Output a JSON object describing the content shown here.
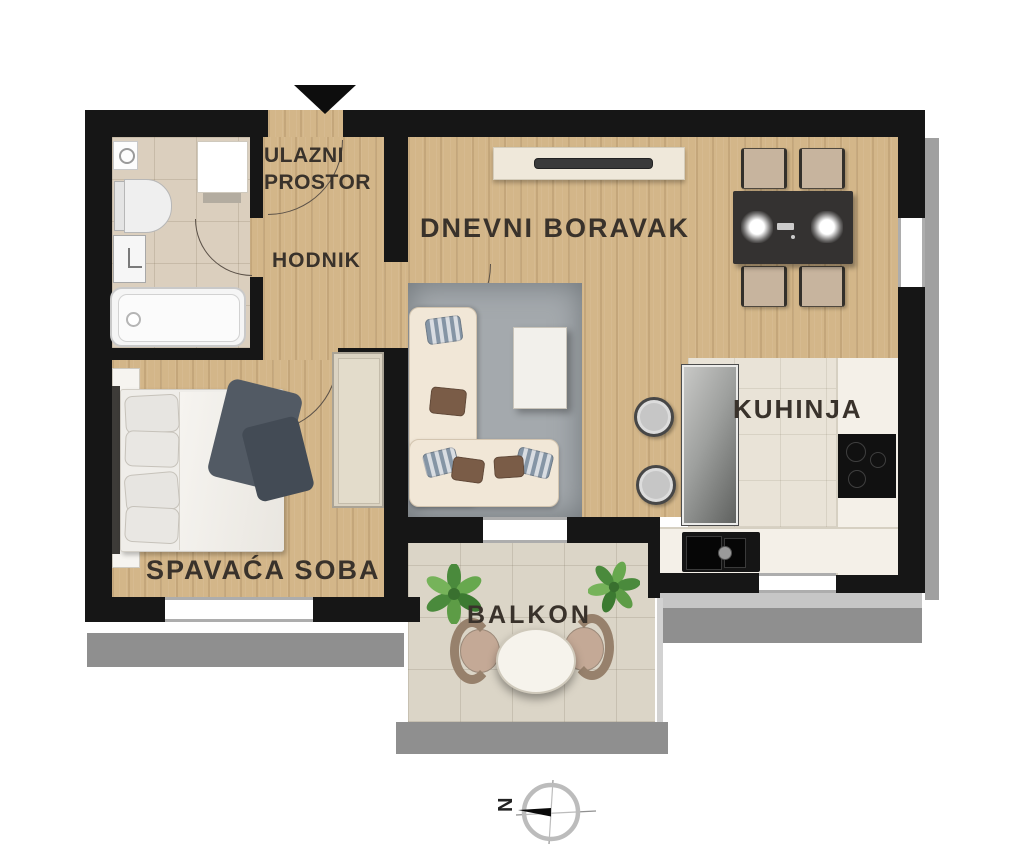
{
  "rooms": {
    "entry": {
      "line1": "ULAZNI",
      "line2": "PROSTOR"
    },
    "hallway": {
      "label": "HODNIK"
    },
    "living_room": {
      "label": "DNEVNI BORAVAK"
    },
    "kitchen": {
      "label": "KUHINJA"
    },
    "bedroom": {
      "label": "SPAVAĆA SOBA"
    },
    "balcony": {
      "label": "BALKON"
    }
  },
  "compass": {
    "north_label": "N",
    "needle_points": "left"
  },
  "entry_marker": {
    "type": "entrance-arrow",
    "points": "down"
  },
  "colors": {
    "wall": "#161616",
    "wood_floor": "#d3b689",
    "bathroom_tile": "#dbcfbe",
    "kitchen_tile": "#e9e3d7",
    "balcony_tile": "#dbd5c7",
    "building_shadow": "#8f8f8f",
    "rug": "#a4a9ad",
    "sofa": "#f1e7d7",
    "dining_table": "#343231",
    "plant_green": "#4a8a3c",
    "label_text": "#39322b"
  },
  "furniture": {
    "bathroom": [
      "toilet",
      "washing-machine",
      "bathtub",
      "washbasin",
      "floor-drain"
    ],
    "living_room": [
      "tv-cabinet",
      "dining-table",
      "dining-chairs",
      "corner-sofa",
      "coffee-table",
      "area-rug",
      "stools"
    ],
    "kitchen": [
      "tall-cabinet",
      "counter",
      "cooktop",
      "sink"
    ],
    "bedroom": [
      "double-bed",
      "pillows",
      "blanket",
      "nightstands",
      "wardrobe"
    ],
    "balcony": [
      "plants",
      "bistro-table",
      "patio-chairs"
    ]
  }
}
